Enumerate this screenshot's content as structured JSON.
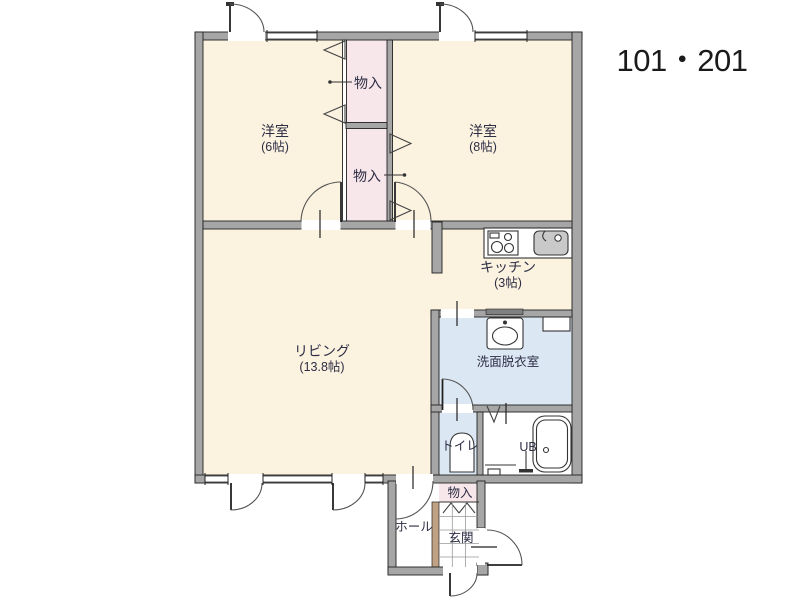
{
  "title": "101・201",
  "colors": {
    "wall": "#a6a6a6",
    "floor": "#fbf2e0",
    "closet_pink": "#f7e6ea",
    "wet_blue": "#dbe8f4",
    "step_tan": "#bfa183",
    "label_text": "#2e2e45",
    "title_text": "#1a1a1a"
  },
  "rooms": {
    "bedroom6": {
      "name": "洋室",
      "size": "(6帖)"
    },
    "bedroom8": {
      "name": "洋室",
      "size": "(8帖)"
    },
    "closet_upper": {
      "name": "物入"
    },
    "closet_lower": {
      "name": "物入"
    },
    "kitchen": {
      "name": "キッチン",
      "size": "(3帖)"
    },
    "living": {
      "name": "リビング",
      "size": "(13.8帖)"
    },
    "washroom": {
      "name": "洗面脱衣室"
    },
    "toilet": {
      "name": "トイレ"
    },
    "bath": {
      "name": "UB"
    },
    "entrance_closet": {
      "name": "物入"
    },
    "entrance": {
      "name": "玄関"
    },
    "hall": {
      "name": "ホール"
    }
  }
}
